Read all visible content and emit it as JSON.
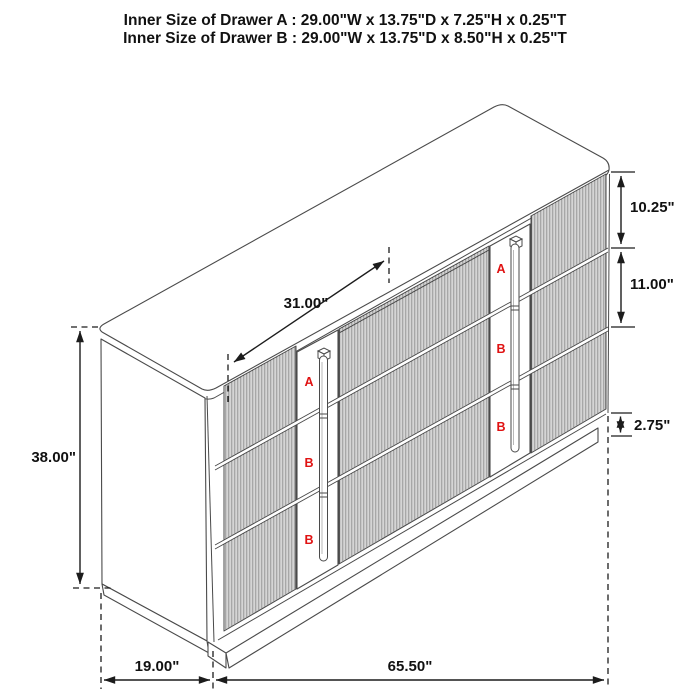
{
  "title": {
    "line1": "Inner Size of Drawer A : 29.00\"W x 13.75\"D x 7.25\"H x 0.25\"T",
    "line2": "Inner Size of Drawer B : 29.00\"W x 13.75\"D x 8.50\"H x 0.25\"T"
  },
  "dimension_labels": {
    "drawer_bank_width": "31.00\"",
    "top_drawer_height": "10.25\"",
    "middle_drawer_height": "11.00\"",
    "base_height": "2.75\"",
    "overall_height": "38.00\"",
    "depth": "19.00\"",
    "overall_width": "65.50\""
  },
  "drawer_labels": {
    "left_stile": [
      "A",
      "B",
      "B"
    ],
    "right_stile": [
      "A",
      "B",
      "B"
    ]
  },
  "colors": {
    "line": "#4a4a4a",
    "dimension": "#1c1c1c",
    "drawer_label": "#e01212",
    "background": "#ffffff"
  }
}
